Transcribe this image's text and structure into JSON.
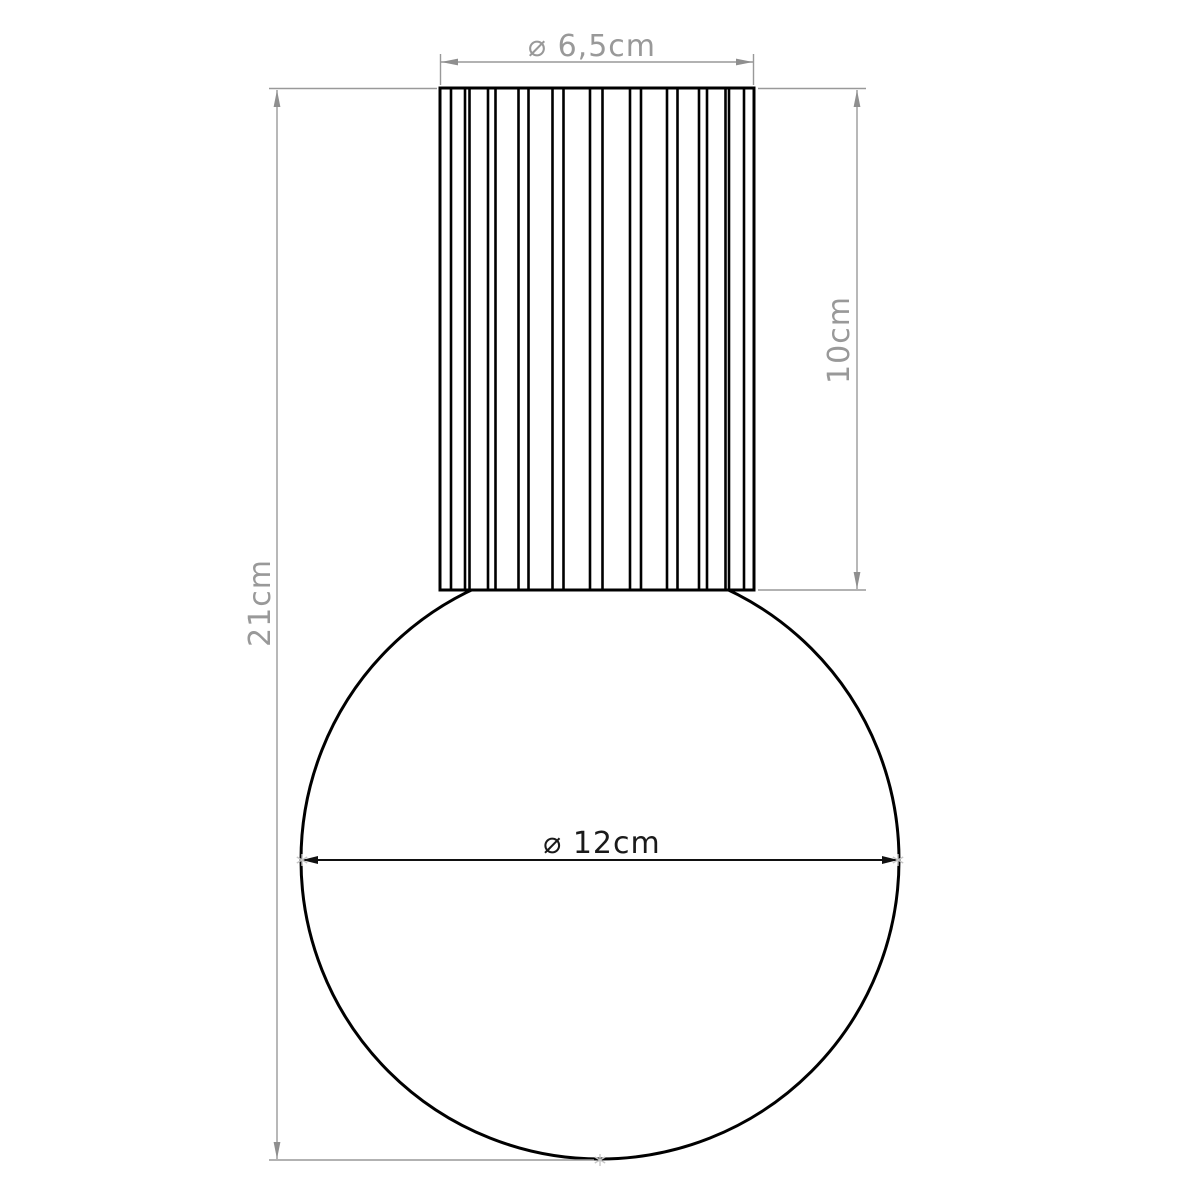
{
  "drawing": {
    "type": "technical-dimension-diagram",
    "background_color": "#ffffff",
    "outline_color": "#000000",
    "dimension_color": "#999999",
    "dark_label_color": "#1a1a1a",
    "tangent_marker_color": "#c6c6c6",
    "dimensions": {
      "cylinder_diameter": {
        "label": "⌀ 6,5cm"
      },
      "cylinder_height": {
        "label": "10cm"
      },
      "overall_height": {
        "label": "21cm"
      },
      "globe_diameter": {
        "label": "⌀ 12cm"
      }
    }
  }
}
